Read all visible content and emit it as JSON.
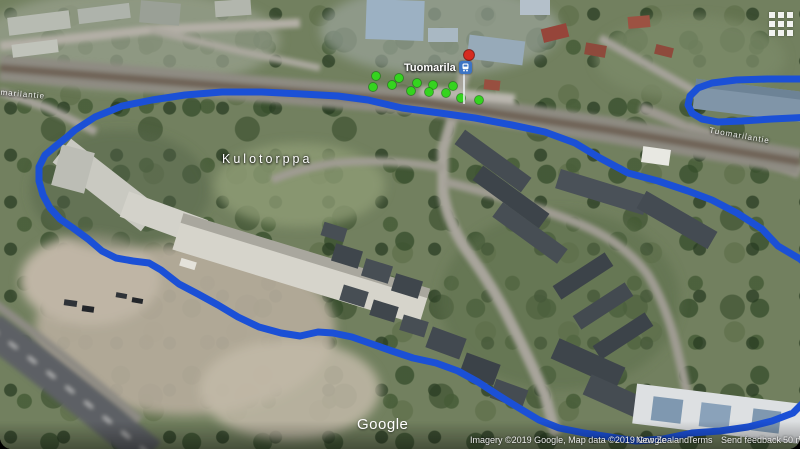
{
  "colors": {
    "route": "#1b50d6",
    "marker_green": "#35d41f",
    "marker_red": "#d62b20",
    "station_blue": "#3d74c4"
  },
  "labels": {
    "place": "Kulotorppa",
    "station": "Tuomarila",
    "street_left": "Tuomarilantie",
    "street_right": "Tuomarilantie",
    "watermark": "Google"
  },
  "attribution": {
    "imagery": "Imagery ©2019 Google, Map data ©2019 Google",
    "region": "New Zealand",
    "terms": "Terms",
    "feedback": "Send feedback",
    "scale": "50 m"
  },
  "route": {
    "stroke_width": 7,
    "loop_points": [
      [
        75,
        130
      ],
      [
        95,
        117
      ],
      [
        122,
        106
      ],
      [
        152,
        100
      ],
      [
        185,
        95
      ],
      [
        222,
        92
      ],
      [
        262,
        92
      ],
      [
        302,
        94
      ],
      [
        338,
        96
      ],
      [
        368,
        100
      ],
      [
        402,
        108
      ],
      [
        440,
        113
      ],
      [
        475,
        118
      ],
      [
        512,
        125
      ],
      [
        545,
        132
      ],
      [
        575,
        143
      ],
      [
        600,
        158
      ],
      [
        628,
        173
      ],
      [
        658,
        181
      ],
      [
        688,
        191
      ],
      [
        712,
        200
      ],
      [
        737,
        213
      ],
      [
        762,
        229
      ],
      [
        778,
        246
      ],
      [
        800,
        259
      ],
      [
        815,
        272
      ],
      [
        820,
        310
      ],
      [
        820,
        365
      ],
      [
        808,
        398
      ],
      [
        793,
        413
      ],
      [
        772,
        421
      ],
      [
        748,
        427
      ],
      [
        720,
        431
      ],
      [
        692,
        433
      ],
      [
        663,
        439
      ],
      [
        636,
        441
      ],
      [
        610,
        437
      ],
      [
        584,
        433
      ],
      [
        559,
        428
      ],
      [
        539,
        420
      ],
      [
        519,
        408
      ],
      [
        498,
        395
      ],
      [
        478,
        382
      ],
      [
        458,
        371
      ],
      [
        436,
        363
      ],
      [
        413,
        358
      ],
      [
        392,
        351
      ],
      [
        372,
        344
      ],
      [
        352,
        337
      ],
      [
        333,
        333
      ],
      [
        318,
        332
      ],
      [
        300,
        336
      ],
      [
        281,
        333
      ],
      [
        259,
        327
      ],
      [
        238,
        317
      ],
      [
        218,
        305
      ],
      [
        198,
        294
      ],
      [
        179,
        284
      ],
      [
        161,
        270
      ],
      [
        149,
        263
      ],
      [
        133,
        261
      ],
      [
        116,
        258
      ],
      [
        102,
        251
      ],
      [
        88,
        239
      ],
      [
        73,
        228
      ],
      [
        60,
        219
      ],
      [
        50,
        208
      ],
      [
        43,
        195
      ],
      [
        39,
        181
      ],
      [
        39,
        167
      ],
      [
        45,
        155
      ],
      [
        57,
        145
      ],
      [
        67,
        137
      ]
    ],
    "capsule_points": [
      [
        812,
        79
      ],
      [
        768,
        79
      ],
      [
        736,
        80
      ],
      [
        712,
        83
      ],
      [
        698,
        88
      ],
      [
        690,
        96
      ],
      [
        688,
        105
      ],
      [
        692,
        113
      ],
      [
        702,
        119
      ],
      [
        718,
        122
      ],
      [
        742,
        121
      ],
      [
        772,
        119
      ],
      [
        812,
        117
      ]
    ]
  },
  "markers": {
    "green_radius": 4.5,
    "green_points": [
      [
        376,
        76
      ],
      [
        399,
        78
      ],
      [
        373,
        87
      ],
      [
        392,
        85
      ],
      [
        417,
        83
      ],
      [
        433,
        85
      ],
      [
        411,
        91
      ],
      [
        429,
        92
      ],
      [
        446,
        93
      ],
      [
        453,
        86
      ],
      [
        461,
        98
      ],
      [
        479,
        100
      ]
    ],
    "red_point": [
      469,
      55
    ],
    "red_radius": 5.5
  }
}
